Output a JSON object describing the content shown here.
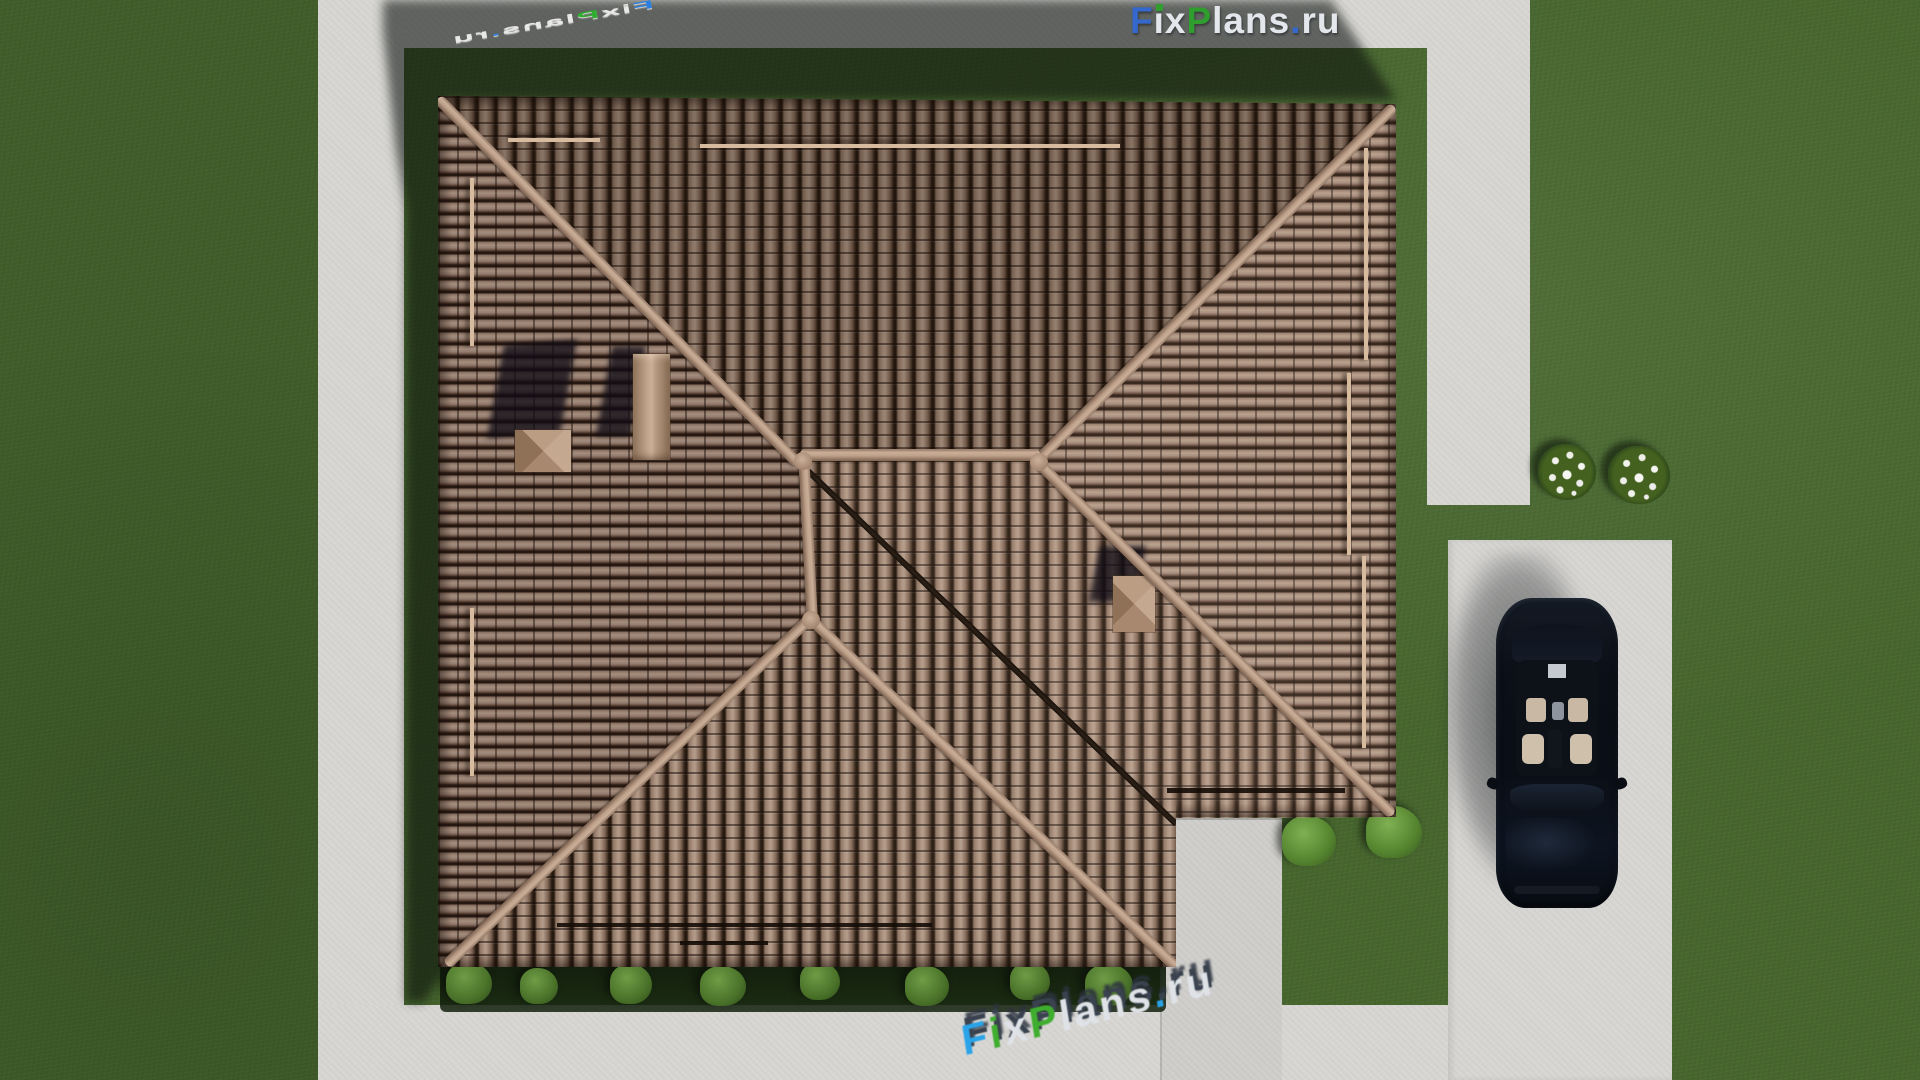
{
  "brand": {
    "full_name": "FixPlans.ru",
    "segments": {
      "f": "F",
      "i": "i",
      "x": "x",
      "p": "P",
      "lans": "lans",
      "dot": ".",
      "ru": "ru"
    },
    "colors": {
      "logo_blue": "#3568cd",
      "logo_green": "#2f9e2f",
      "logo_light": "#e3e7ec",
      "watermark_azure": "#2aa3e8",
      "watermark_green": "#3fae2e"
    }
  },
  "watermarks": {
    "logo_top_right": "FixPlans.ru",
    "ground_top_left": "FixPlans.ru",
    "ground_bottom": "FixPlans.ru"
  },
  "scene": {
    "objects": [
      "hip-roof house top view",
      "clay tile roof with ridges and valley",
      "two chimneys and roof vent",
      "snow-guard bars",
      "black car parked on driveway",
      "concrete walkways around lawn",
      "hedge along house eave",
      "two white flower bushes",
      "house shadow cast to upper-left"
    ],
    "palette": {
      "grass": "#47662e",
      "grass_shadow": "#1c2a16",
      "concrete": "#d7d6d3",
      "roof_tile_light": "#b49c8a",
      "roof_tile_dark": "#26190f",
      "roof_ridge": "#c6ab96",
      "car_body": "#0a0e16",
      "car_interior": "#c9b9a4"
    }
  }
}
